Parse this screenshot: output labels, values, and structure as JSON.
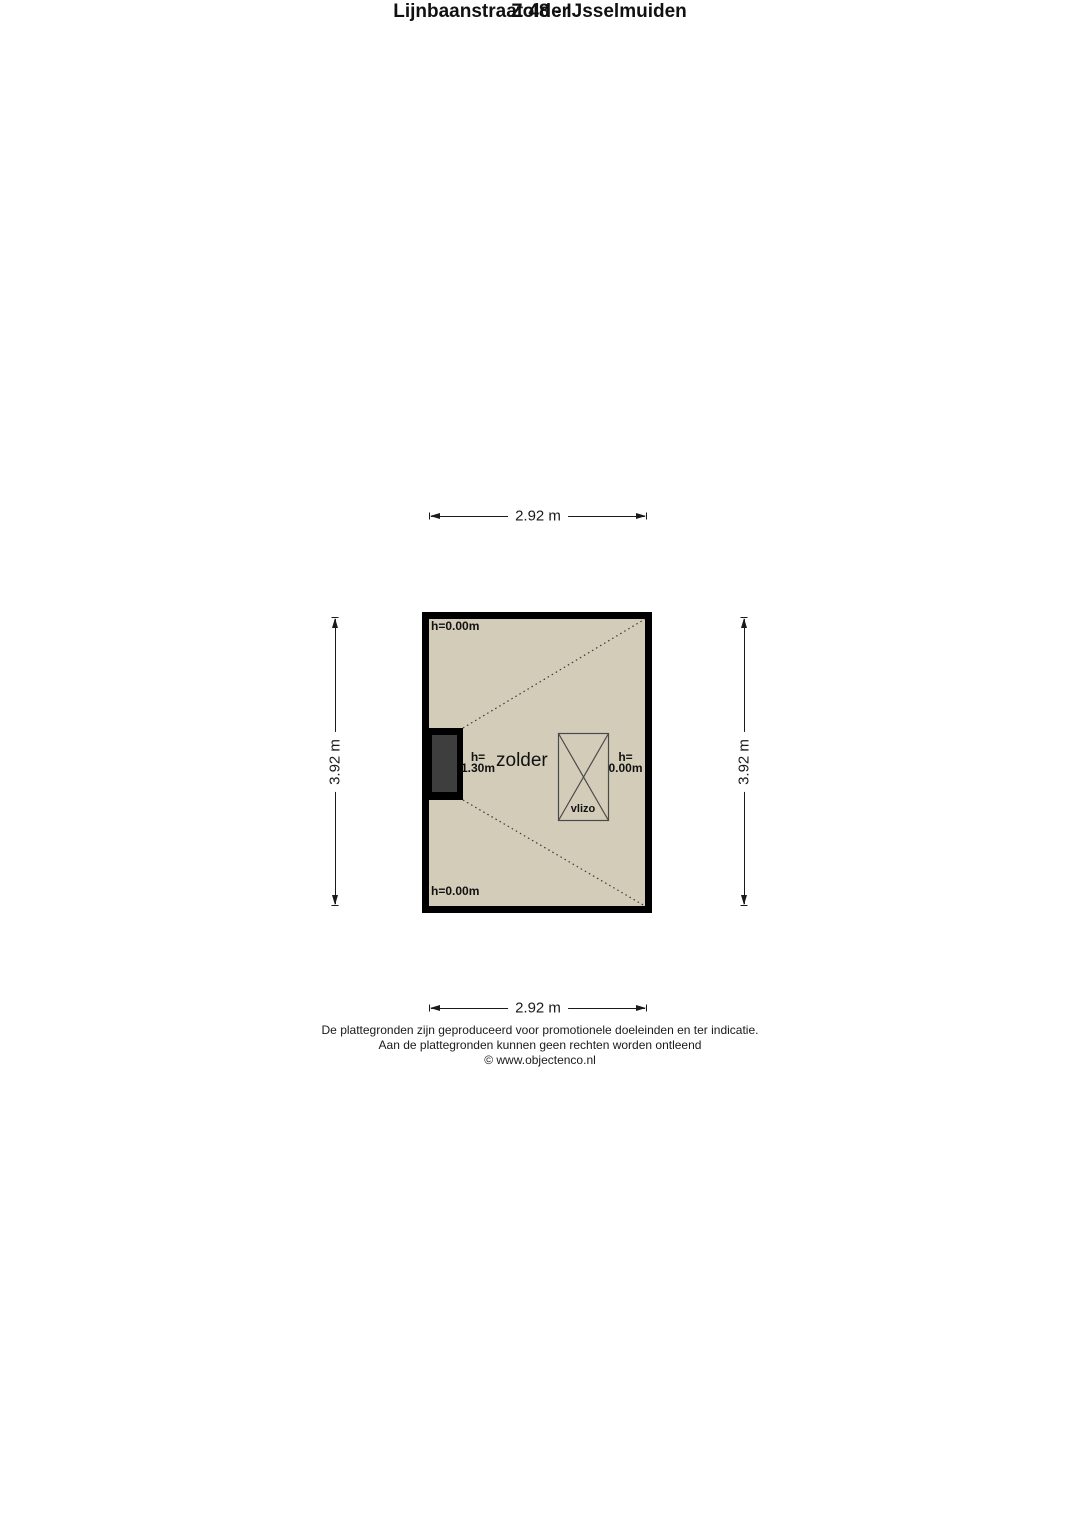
{
  "title": {
    "line1": "Lijnbaanstraat 48 - IJsselmuiden",
    "line2": "Zolder"
  },
  "dimensions": {
    "top": "2.92 m",
    "bottom": "2.92 m",
    "left": "3.92 m",
    "right": "3.92 m"
  },
  "room": {
    "name": "zolder",
    "labels": {
      "top_left_height": "h=0.00m",
      "bottom_left_height": "h=0.00m",
      "left_height_line1": "h=",
      "left_height_line2": "1.30m",
      "right_height_line1": "h=",
      "right_height_line2": "0.00m",
      "hatch": "vlizo"
    },
    "colors": {
      "floor": "#d2ccb9",
      "wall": "#000000",
      "chimney_fill": "#3e3e3e",
      "hatch_stroke": "#4a4a4a",
      "dotted_line": "#3a3a32"
    }
  },
  "footer": {
    "line1": "De plattegronden zijn geproduceerd voor promotionele doeleinden en ter indicatie.",
    "line2": "Aan de plattegronden kunnen geen rechten worden ontleend",
    "line3": "© www.objectenco.nl"
  }
}
